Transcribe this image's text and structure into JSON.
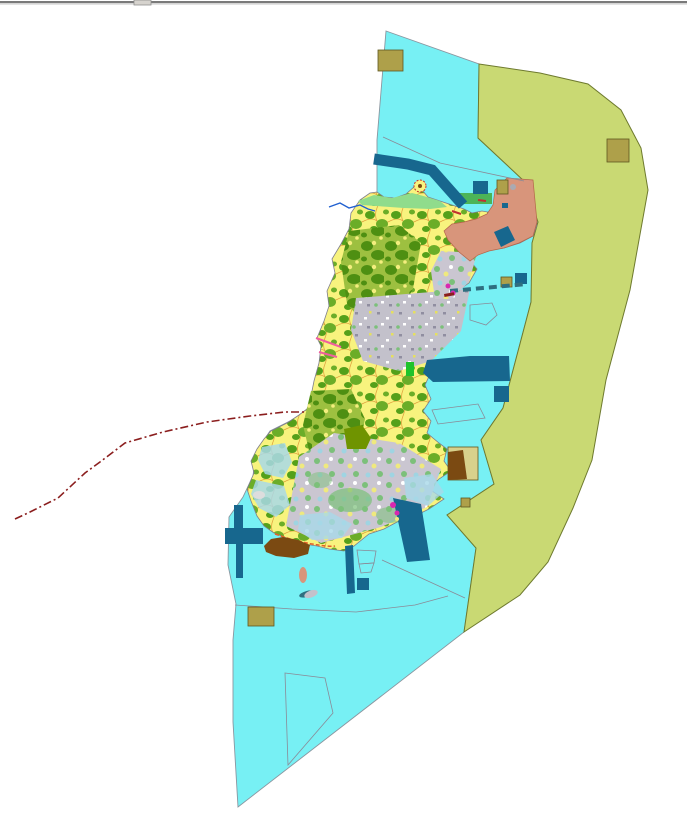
{
  "map": {
    "title": "",
    "colors": {
      "background": "#FFFFFF",
      "window_border_dark": "#7A7A7A",
      "window_border_light": "#DCDCDC",
      "window_tab": "#D6D3CE",
      "window_tab_edge": "#8F8F8F",
      "sea": "#77F0F4",
      "sea_outline": "#8A96A0",
      "coastal_zone": "#C9D973",
      "coastal_outline": "#6E7A2E",
      "island_outline": "#7E7E8C",
      "farm_bg": "#F8F37E",
      "farm_green_1": "#54A01A",
      "farm_green_2": "#6BAD28",
      "farm_line": "#E0A43F",
      "forest_bg": "#9DC040",
      "forest_green": "#4E8F12",
      "forest_gap": "#F4EE7E",
      "urban_bg": "#C3C1CB",
      "urban_speckle_dark": "#908EA0",
      "urban_speckle_light": "#FFFFFF",
      "urban_speckle_yellow": "#E6E05E",
      "mixed_bg": "#CAC6D1",
      "mixed_green": "#7CC07A",
      "mixed_yellow": "#EFE97E",
      "mixed_blue": "#9FD4E2",
      "shore_green": "#90DC8C",
      "green_parcel": "#4CB457",
      "bright_green": "#1FC32B",
      "dark_olive_parcel": "#6F9400",
      "salmon": "#D8957B",
      "salmon_outline": "#B4654A",
      "water_dark": "#17678E",
      "bridge_teal": "#2F6F80",
      "khaki": "#AEA04A",
      "khaki_pale": "#D8D18C",
      "khaki_outline": "#5F5720",
      "brown": "#7B4A12",
      "boundary_red": "#8B1E1E",
      "pink_line": "#F0609E",
      "magenta_mark": "#D828B0",
      "stream_blue": "#2060D0",
      "pale_blue": "#A8D8E8",
      "grey_patch": "#DDDDDD",
      "gray_dot": "#AAAAB2",
      "coast_orange": "#E2602A",
      "red_mark": "#C03030",
      "line_gray": "#8A8A97"
    },
    "features": [
      "window-border",
      "sea-area",
      "eastern-coastal-zone",
      "island-landmass",
      "north-farmland",
      "forest-clusters",
      "central-urban-area",
      "southern-mixed-area",
      "northeast-salmon-district",
      "north-shore-greenbelt",
      "reservoir",
      "north-canal",
      "south-channel",
      "harbor-structures",
      "bridge-route",
      "administrative-boundary",
      "cadastral-outlines",
      "khaki-parcels",
      "brown-tidal-flat",
      "survey-marks"
    ]
  }
}
